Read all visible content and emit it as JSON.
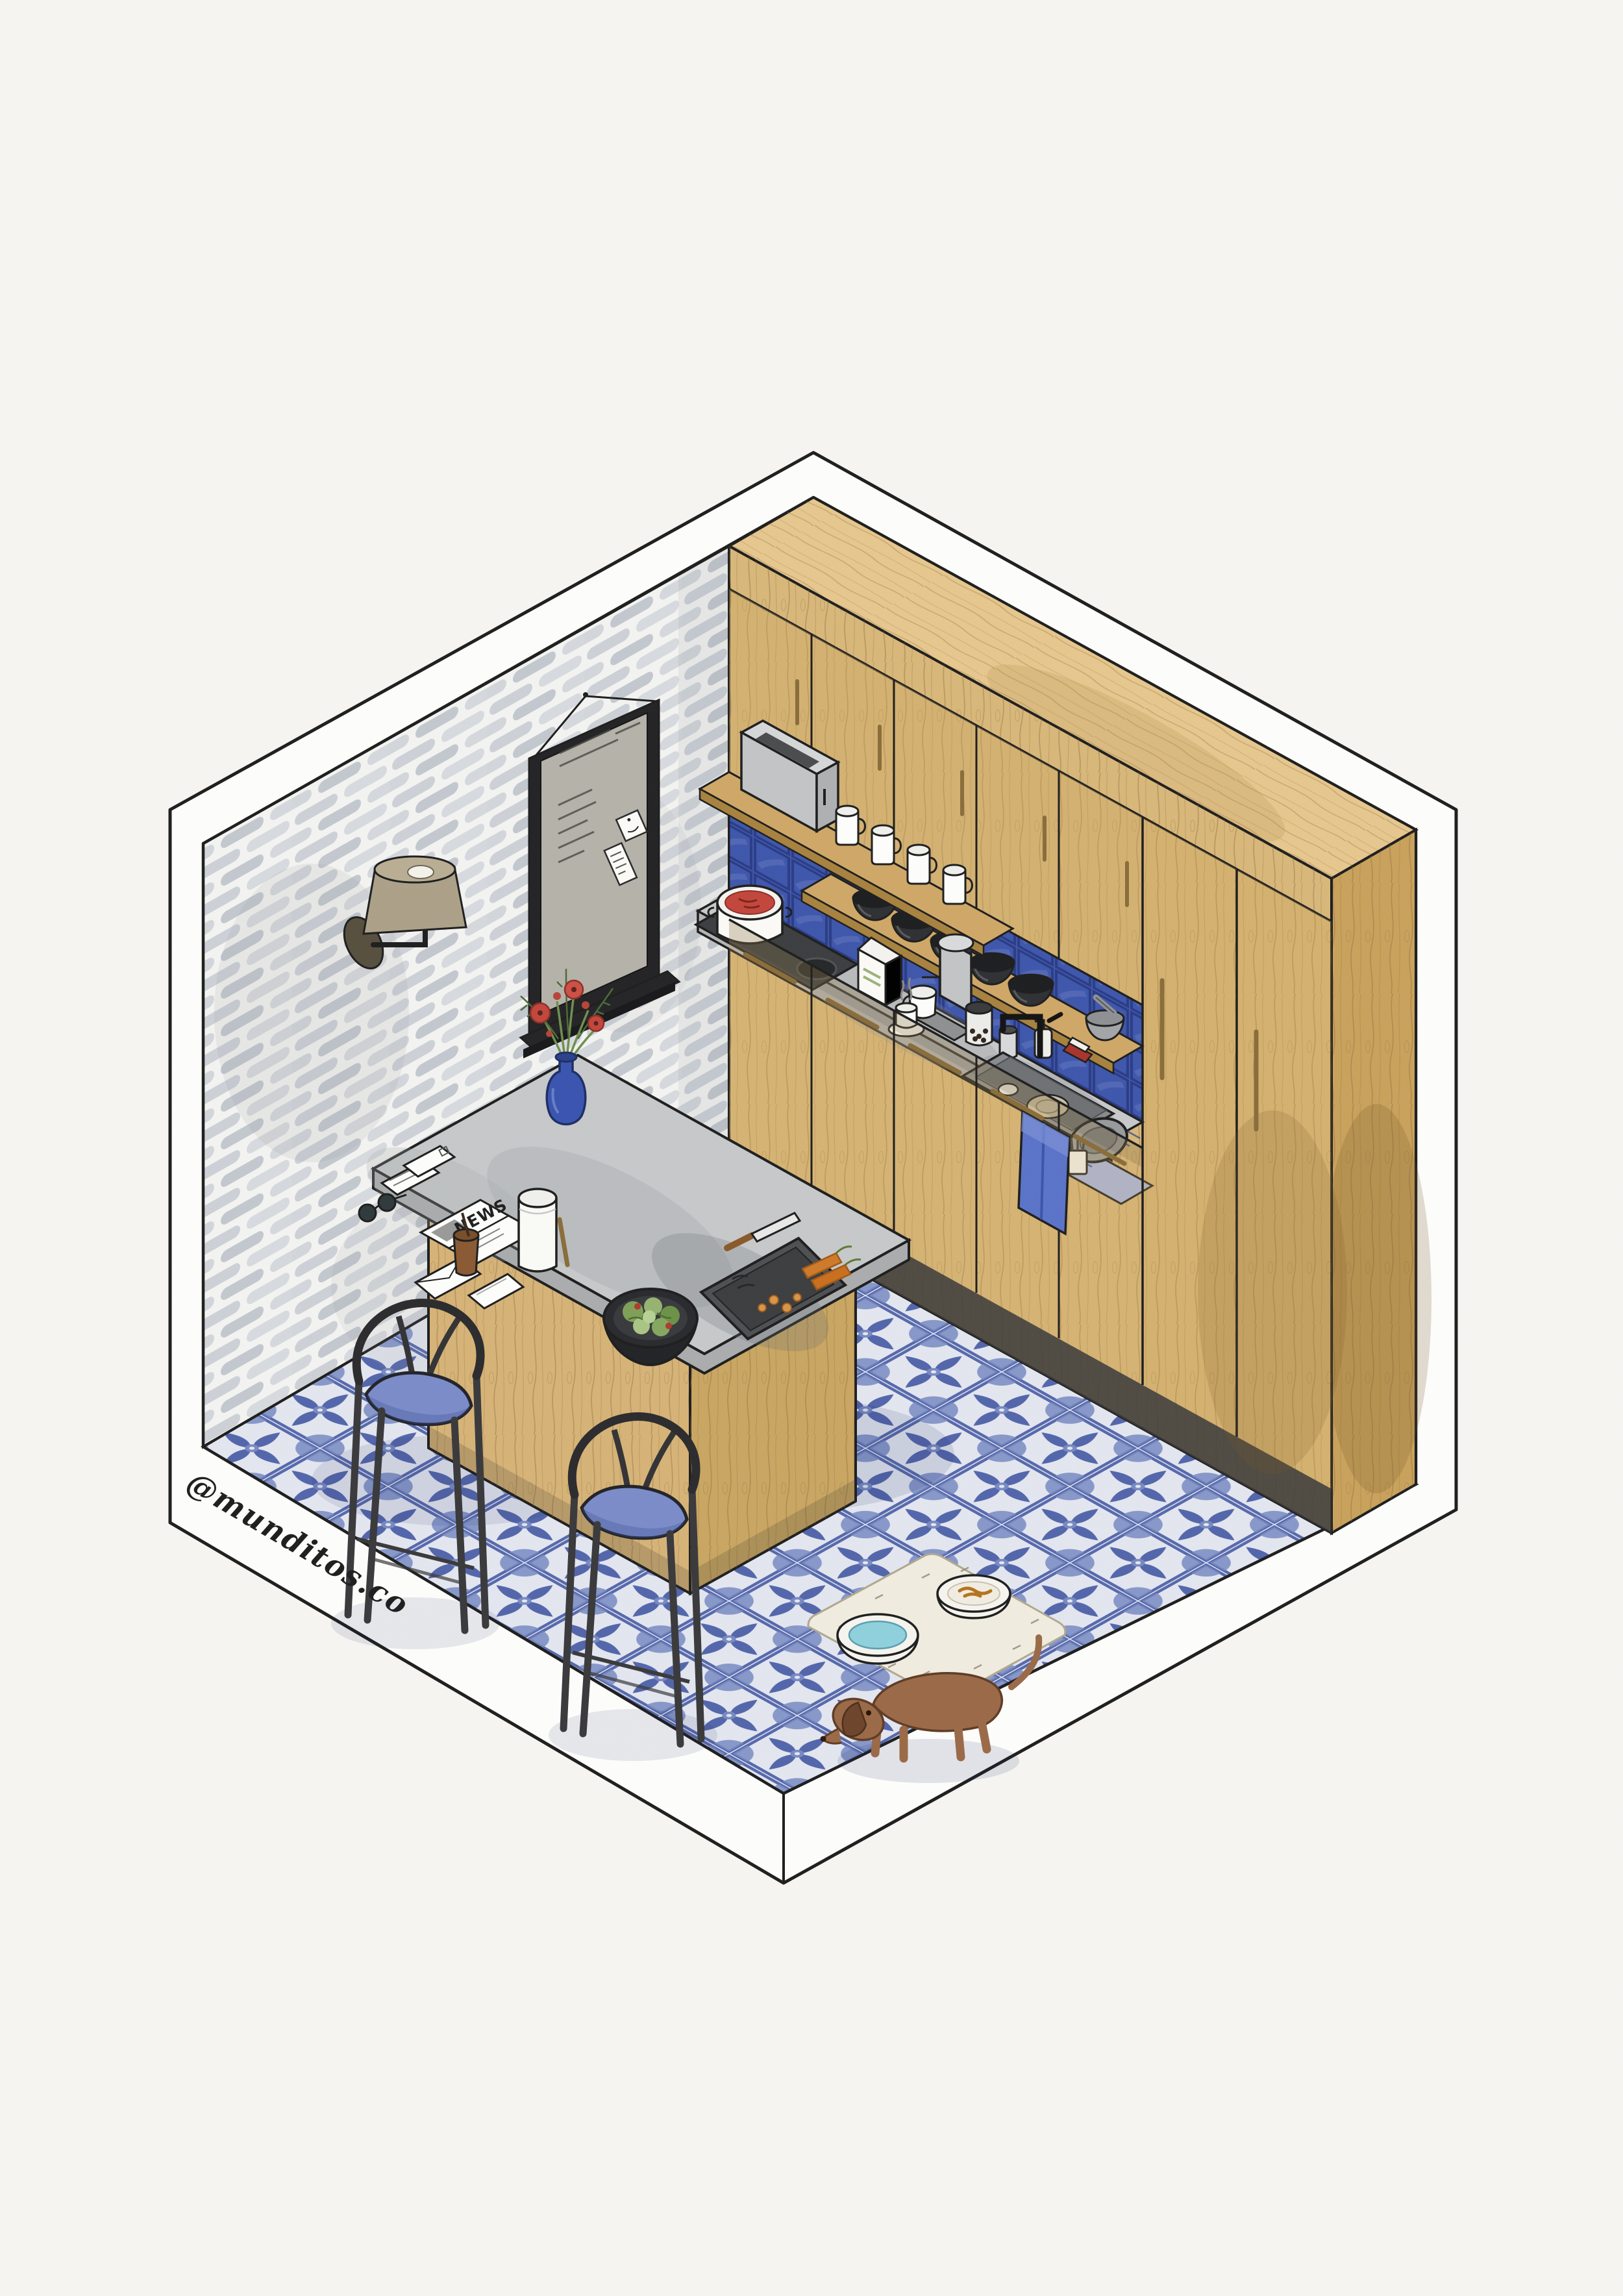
{
  "signature": {
    "handle": "@munditos.co"
  },
  "island": {
    "newspaper_label": "NEWS"
  },
  "colors": {
    "paper": "#f6f5f2",
    "shell": "#fdfdfb",
    "ink": "#1f1f1f",
    "brick_bg": "#f3f3f1",
    "brick": "#ccd0d6",
    "wood": "#d8b77a",
    "wood_top": "#e6c78e",
    "wood_side": "#c9a25c",
    "wood_shelf": "#cfa868",
    "wood_dark": "#8a6a3c",
    "brass": "#8a6d3b",
    "backsplash": "#3f57ab",
    "tile_blue": "#4a5da8",
    "tile_soft": "#7d8fc7",
    "tile_bg": "#eef0f6",
    "concrete": "#c6c8ca",
    "concrete_edge": "#b2b4b6",
    "metal": "#c2c4c6",
    "dark": "#3c3e41",
    "cushion": "#7b8cc9",
    "towel": "#5b74c8",
    "red": "#c2473d",
    "green": "#6f8f4f",
    "water": "#8fd0dc",
    "kibble": "#b5741f",
    "dog": "#9b6a48",
    "dog_dark": "#6e452c",
    "cream": "#f1ece0",
    "white": "#fdfdfb"
  },
  "inventory": {
    "room": "Isometric watercolor kitchen room",
    "brick_wall": "Whitewashed brick wall",
    "cabinets": "Wood kitchen cabinet wall",
    "pantry": "Tall pantry cabinets",
    "counter": "Concrete countertop",
    "sink": "Sink with black faucet",
    "stove": "Cooktop with pot of sauce",
    "coffee_maker": "Drip coffee maker",
    "toaster": "Toaster on shelf",
    "mugs": "Row of white mugs",
    "bowls": "Row of black bowls",
    "shelves": "Open wood shelves with blue tile backsplash",
    "island": "Kitchen island with concrete top",
    "stools": "Two bar stools with blue cushions",
    "mirror": "Framed mirror with notes",
    "sconce": "Wall sconce lamp",
    "vase": "Blue vase with red flowers",
    "newspaper": "Newspaper and mail",
    "salad_bowl": "Salad bowl",
    "cutting_tray": "Tray with knife and carrots",
    "dog": "Dachshund dog",
    "pet_station": "Pet water and food bowls on mat",
    "floor": "Blue azulejo tile floor",
    "towel": "Blue hand towel",
    "dish_rack": "Dish drying rack",
    "signature": "Artist signature"
  }
}
